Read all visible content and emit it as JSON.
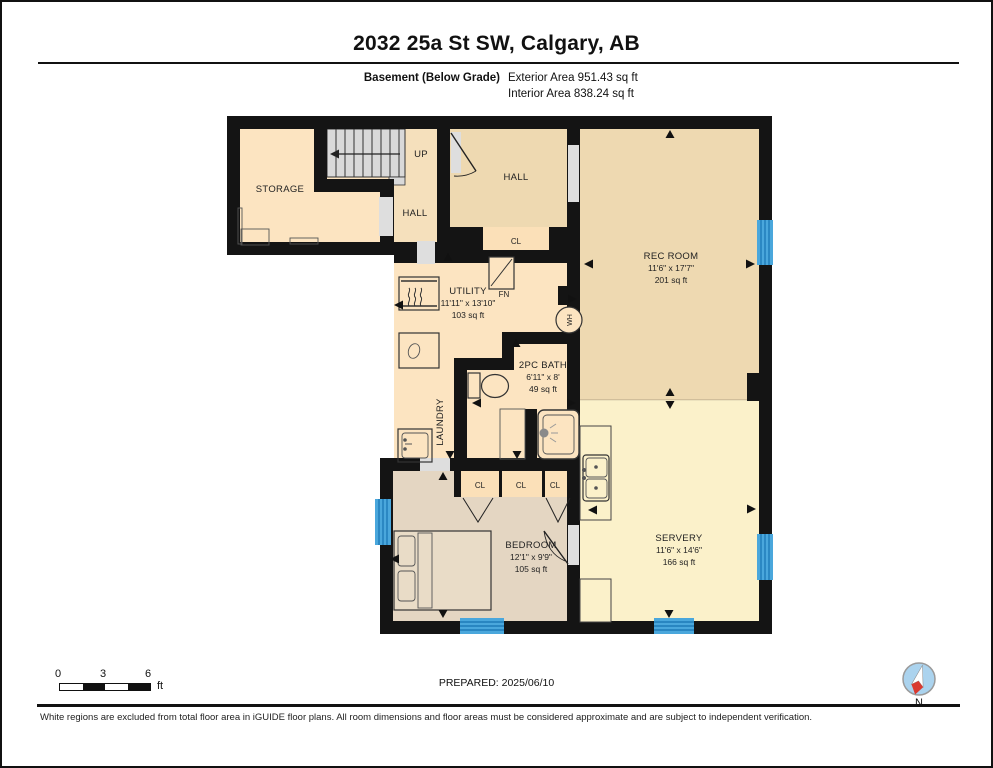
{
  "header": {
    "title": "2032 25a St SW, Calgary, AB",
    "floor_label": "Basement (Below Grade)",
    "exterior_area": "Exterior Area 951.43 sq ft",
    "interior_area": "Interior Area 838.24 sq ft"
  },
  "rooms": {
    "storage": {
      "name": "STORAGE"
    },
    "stairs_up": {
      "label": "UP"
    },
    "hall_stair": {
      "name": "HALL"
    },
    "hall_upper": {
      "name": "HALL"
    },
    "closet": {
      "label": "CL"
    },
    "utility": {
      "name": "UTILITY",
      "dims": "11'11\" x 13'10\"",
      "area": "103 sq ft"
    },
    "rec_room": {
      "name": "REC ROOM",
      "dims": "11'6\" x 17'7\"",
      "area": "201 sq ft"
    },
    "bath": {
      "name": "2PC BATH",
      "dims": "6'11\" x 8'",
      "area": "49 sq ft"
    },
    "laundry": {
      "name": "LAUNDRY"
    },
    "furnace": {
      "label": "FN"
    },
    "water_heater": {
      "label": "WH"
    },
    "bedroom": {
      "name": "BEDROOM",
      "dims": "12'1\" x 9'9\"",
      "area": "105 sq ft"
    },
    "servery": {
      "name": "SERVERY",
      "dims": "11'6\" x 14'6\"",
      "area": "166 sq ft"
    }
  },
  "footer": {
    "scale_ticks": [
      "0",
      "3",
      "6"
    ],
    "scale_unit": "ft",
    "prepared": "PREPARED: 2025/06/10",
    "compass_label": "N"
  },
  "disclaimer": "White regions are excluded from total floor area in iGUIDE floor plans. All room dimensions and floor areas must be considered approximate and are subject to independent verification.",
  "colors": {
    "wall": "#141414",
    "window_blue": "#4aa7dc",
    "window_stripe": "#1e7cb8",
    "hall_tan": "#eed9b1",
    "peach": "#fce4c1",
    "bedroom_tan": "#e4d6c2",
    "servery_yellow": "#fbf1ca",
    "stairs_gray": "#d9d9d9",
    "opening_gray": "#dedede",
    "compass_red": "#d93a30",
    "compass_blue": "#abd3ee"
  }
}
